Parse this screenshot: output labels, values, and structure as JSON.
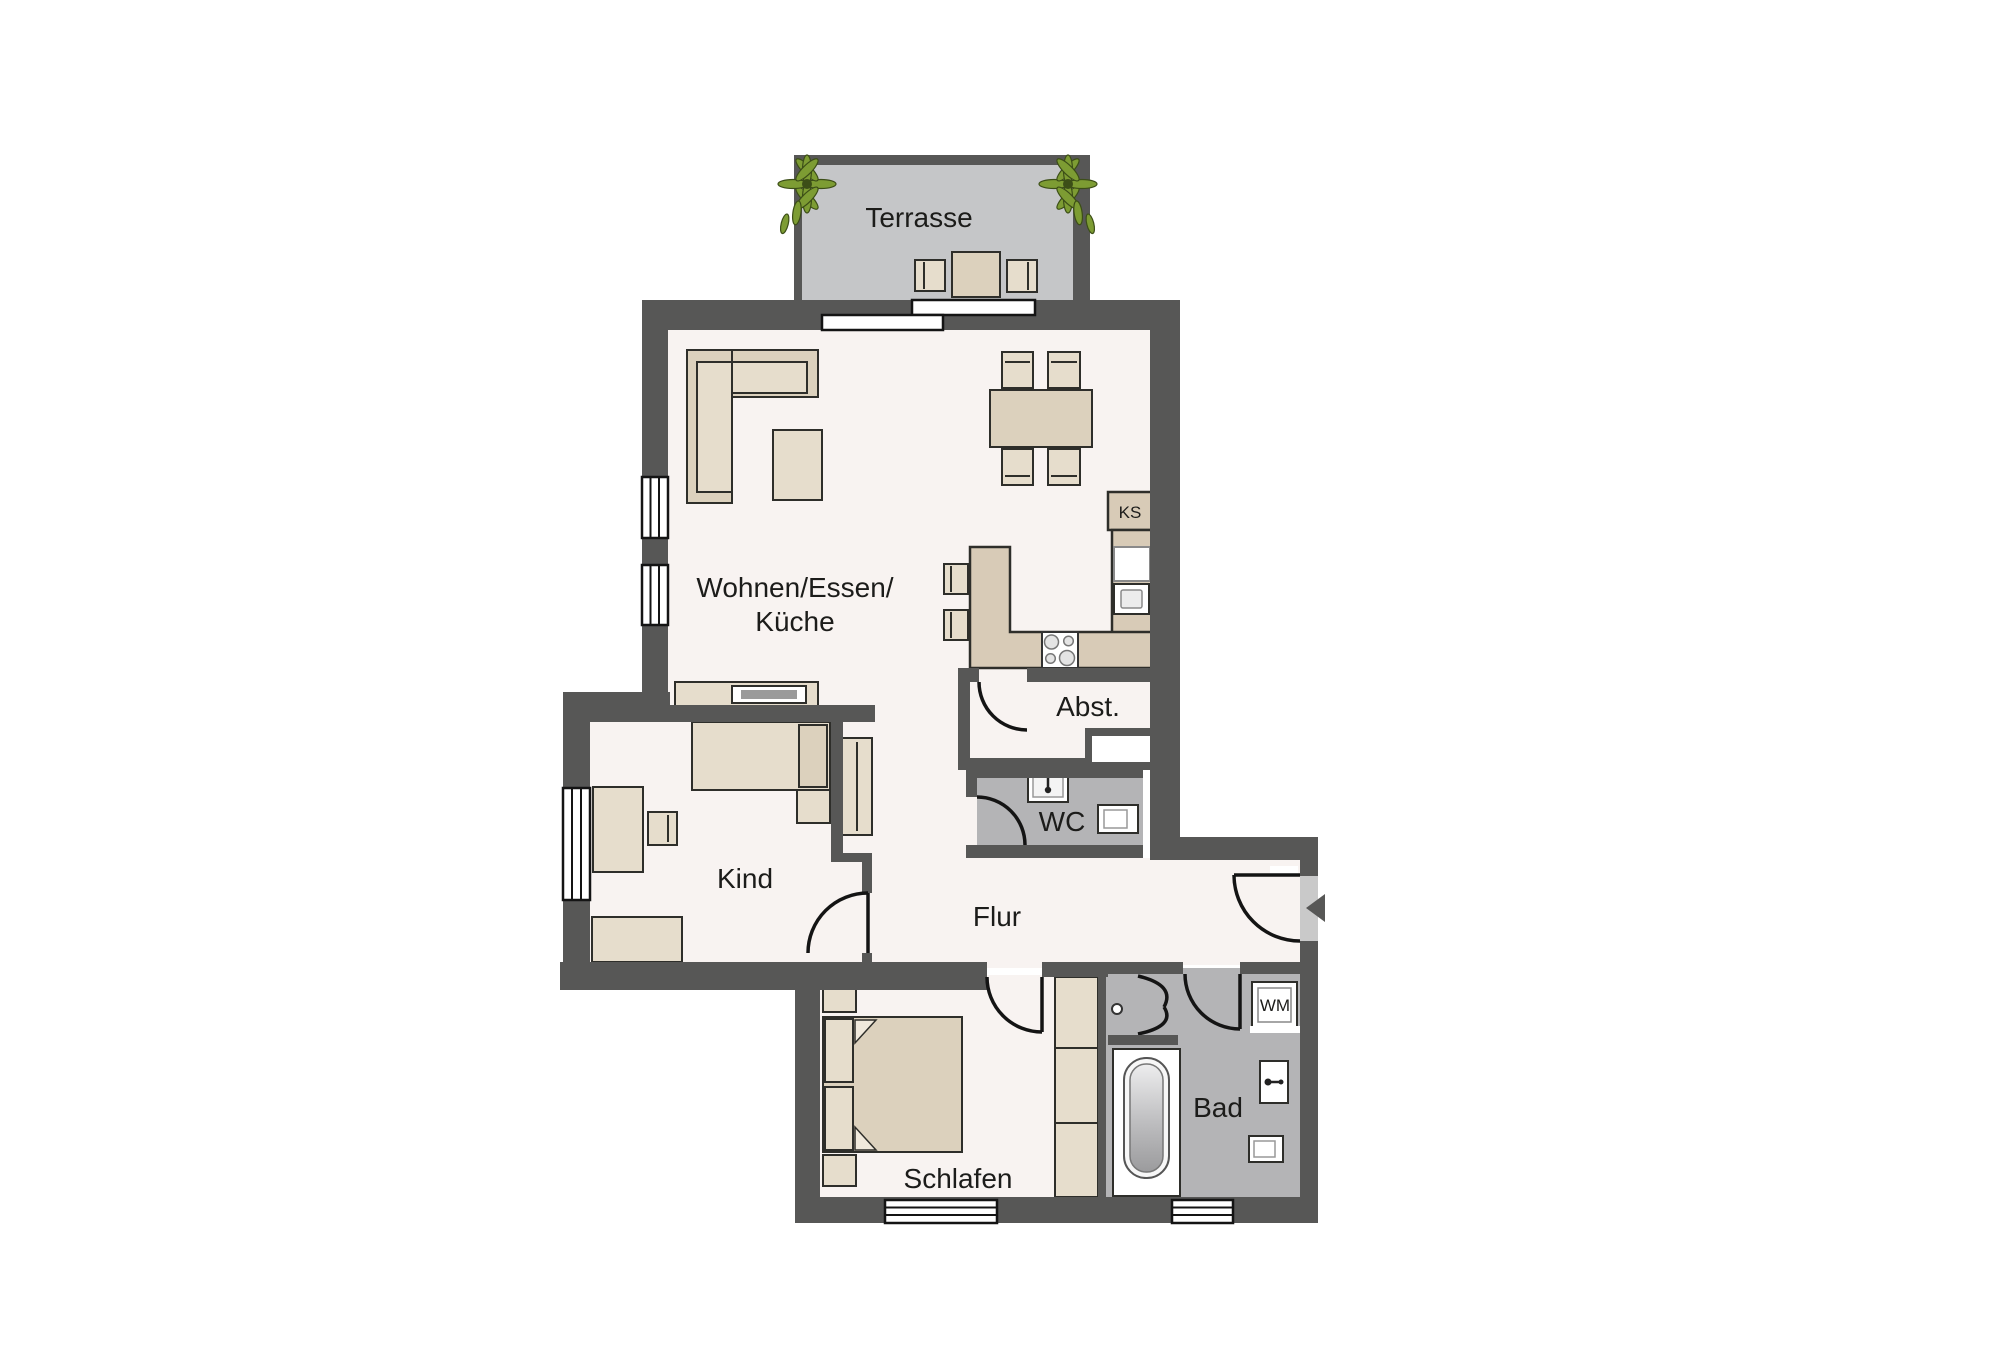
{
  "labels": {
    "terrasse": "Terrasse",
    "wohnen_line1": "Wohnen/Essen/",
    "wohnen_line2": "Küche",
    "abst": "Abst.",
    "wc": "WC",
    "kind": "Kind",
    "flur": "Flur",
    "schlafen": "Schlafen",
    "bad": "Bad",
    "ks": "KS",
    "wm": "WM"
  },
  "colors": {
    "wall": "#575756",
    "floor": "#f8f3f1",
    "wet": "#b4b4b6",
    "terrace": "#c5c6c8",
    "furn": "#e6ddcc",
    "furndark": "#dcd1bd",
    "counter": "#d8cbb7",
    "edge": "#2e2e2a",
    "tv": "#9a9a9a",
    "leaf": "#7d9c33",
    "leafdark": "#3c4e17",
    "doorleaf": "#c9c9c9"
  }
}
